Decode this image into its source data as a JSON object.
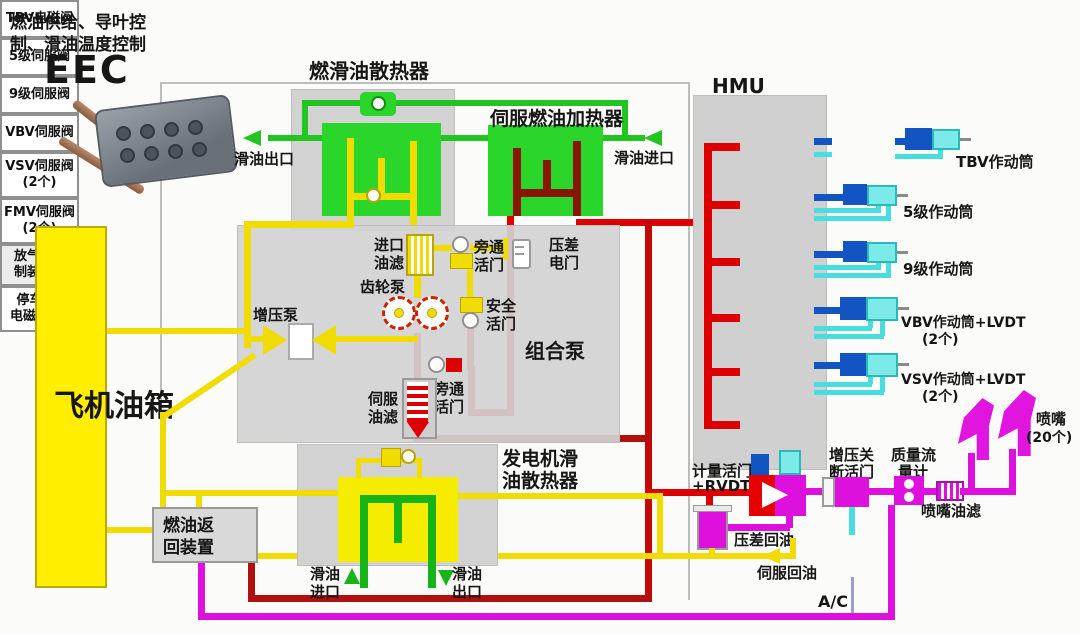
{
  "colors": {
    "pipe_yellow": "#f0dc00",
    "pipe_green": "#21c421",
    "pipe_red": "#dd0000",
    "pipe_dark_red": "#8b1600",
    "pipe_magenta": "#dd10dd",
    "pipe_blue": "#1255c2",
    "pipe_cyan": "#49dede",
    "tank_yellow": "#ffee00",
    "block_green": "#2bd62b",
    "module_grey": "#d2d2d2"
  },
  "header": {
    "subtitle_line1": "燃油供给、导叶控",
    "subtitle_line2": "制、滑油温度控制",
    "eec": "EEC"
  },
  "top": {
    "cooler_title": "燃滑油散热器",
    "heater_title": "伺服燃油加热器",
    "oil_outlet": "滑油出口",
    "oil_inlet": "滑油进口"
  },
  "tank": {
    "label": "飞机油箱"
  },
  "pump_module": {
    "title": "组合泵",
    "inlet_filter_l1": "进口",
    "inlet_filter_l2": "油滤",
    "gear_pump": "齿轮泵",
    "boost_pump": "增压泵",
    "bypass1_l1": "旁通",
    "bypass1_l2": "活门",
    "dp_switch_l1": "压差",
    "dp_switch_l2": "电门",
    "safety_valve_l1": "安全",
    "safety_valve_l2": "活门",
    "bypass2_l1": "旁通",
    "bypass2_l2": "活门",
    "servo_filter_l1": "伺服",
    "servo_filter_l2": "油滤"
  },
  "hmu": {
    "title": "HMU",
    "valves": [
      {
        "label": "TBV电磁阀",
        "qty": ""
      },
      {
        "label": "5级伺服阀",
        "qty": ""
      },
      {
        "label": "9级伺服阀",
        "qty": ""
      },
      {
        "label": "VBV伺服阀",
        "qty": ""
      },
      {
        "label": "VSV伺服阀",
        "qty": "(2个)"
      },
      {
        "label": "FMV伺服阀",
        "qty": "(2个)"
      }
    ]
  },
  "bleed_control": {
    "l1": "放气控",
    "l2": "制装置"
  },
  "actuators": {
    "tbv": "TBV作动筒",
    "s5": "5级作动筒",
    "s9": "9级作动筒",
    "vbv": "VBV作动筒+LVDT",
    "vbv_qty": "(2个)",
    "vsv": "VSV作动筒+LVDT",
    "vsv_qty": "(2个)"
  },
  "fuel_metering": {
    "metering_l1": "计量活门",
    "metering_l2": "+RVDT",
    "shutoff_l1": "增压关",
    "shutoff_l2": "断活门",
    "flowmeter_l1": "质量流",
    "flowmeter_l2": "量计",
    "nozzle_filter": "喷嘴油滤",
    "nozzle": "喷嘴",
    "nozzle_qty": "(20个)",
    "dp_return": "压差回油",
    "servo_return": "伺服回油",
    "shutdown_l1": "停车",
    "shutdown_l2": "电磁阀",
    "ac": "A/C"
  },
  "bottom": {
    "gen_cooler_l1": "发电机滑",
    "gen_cooler_l2": "油散热器",
    "oil_in_l1": "滑油",
    "oil_in_l2": "进口",
    "oil_out_l1": "滑油",
    "oil_out_l2": "出口",
    "fuel_return_l1": "燃油返",
    "fuel_return_l2": "回装置"
  }
}
